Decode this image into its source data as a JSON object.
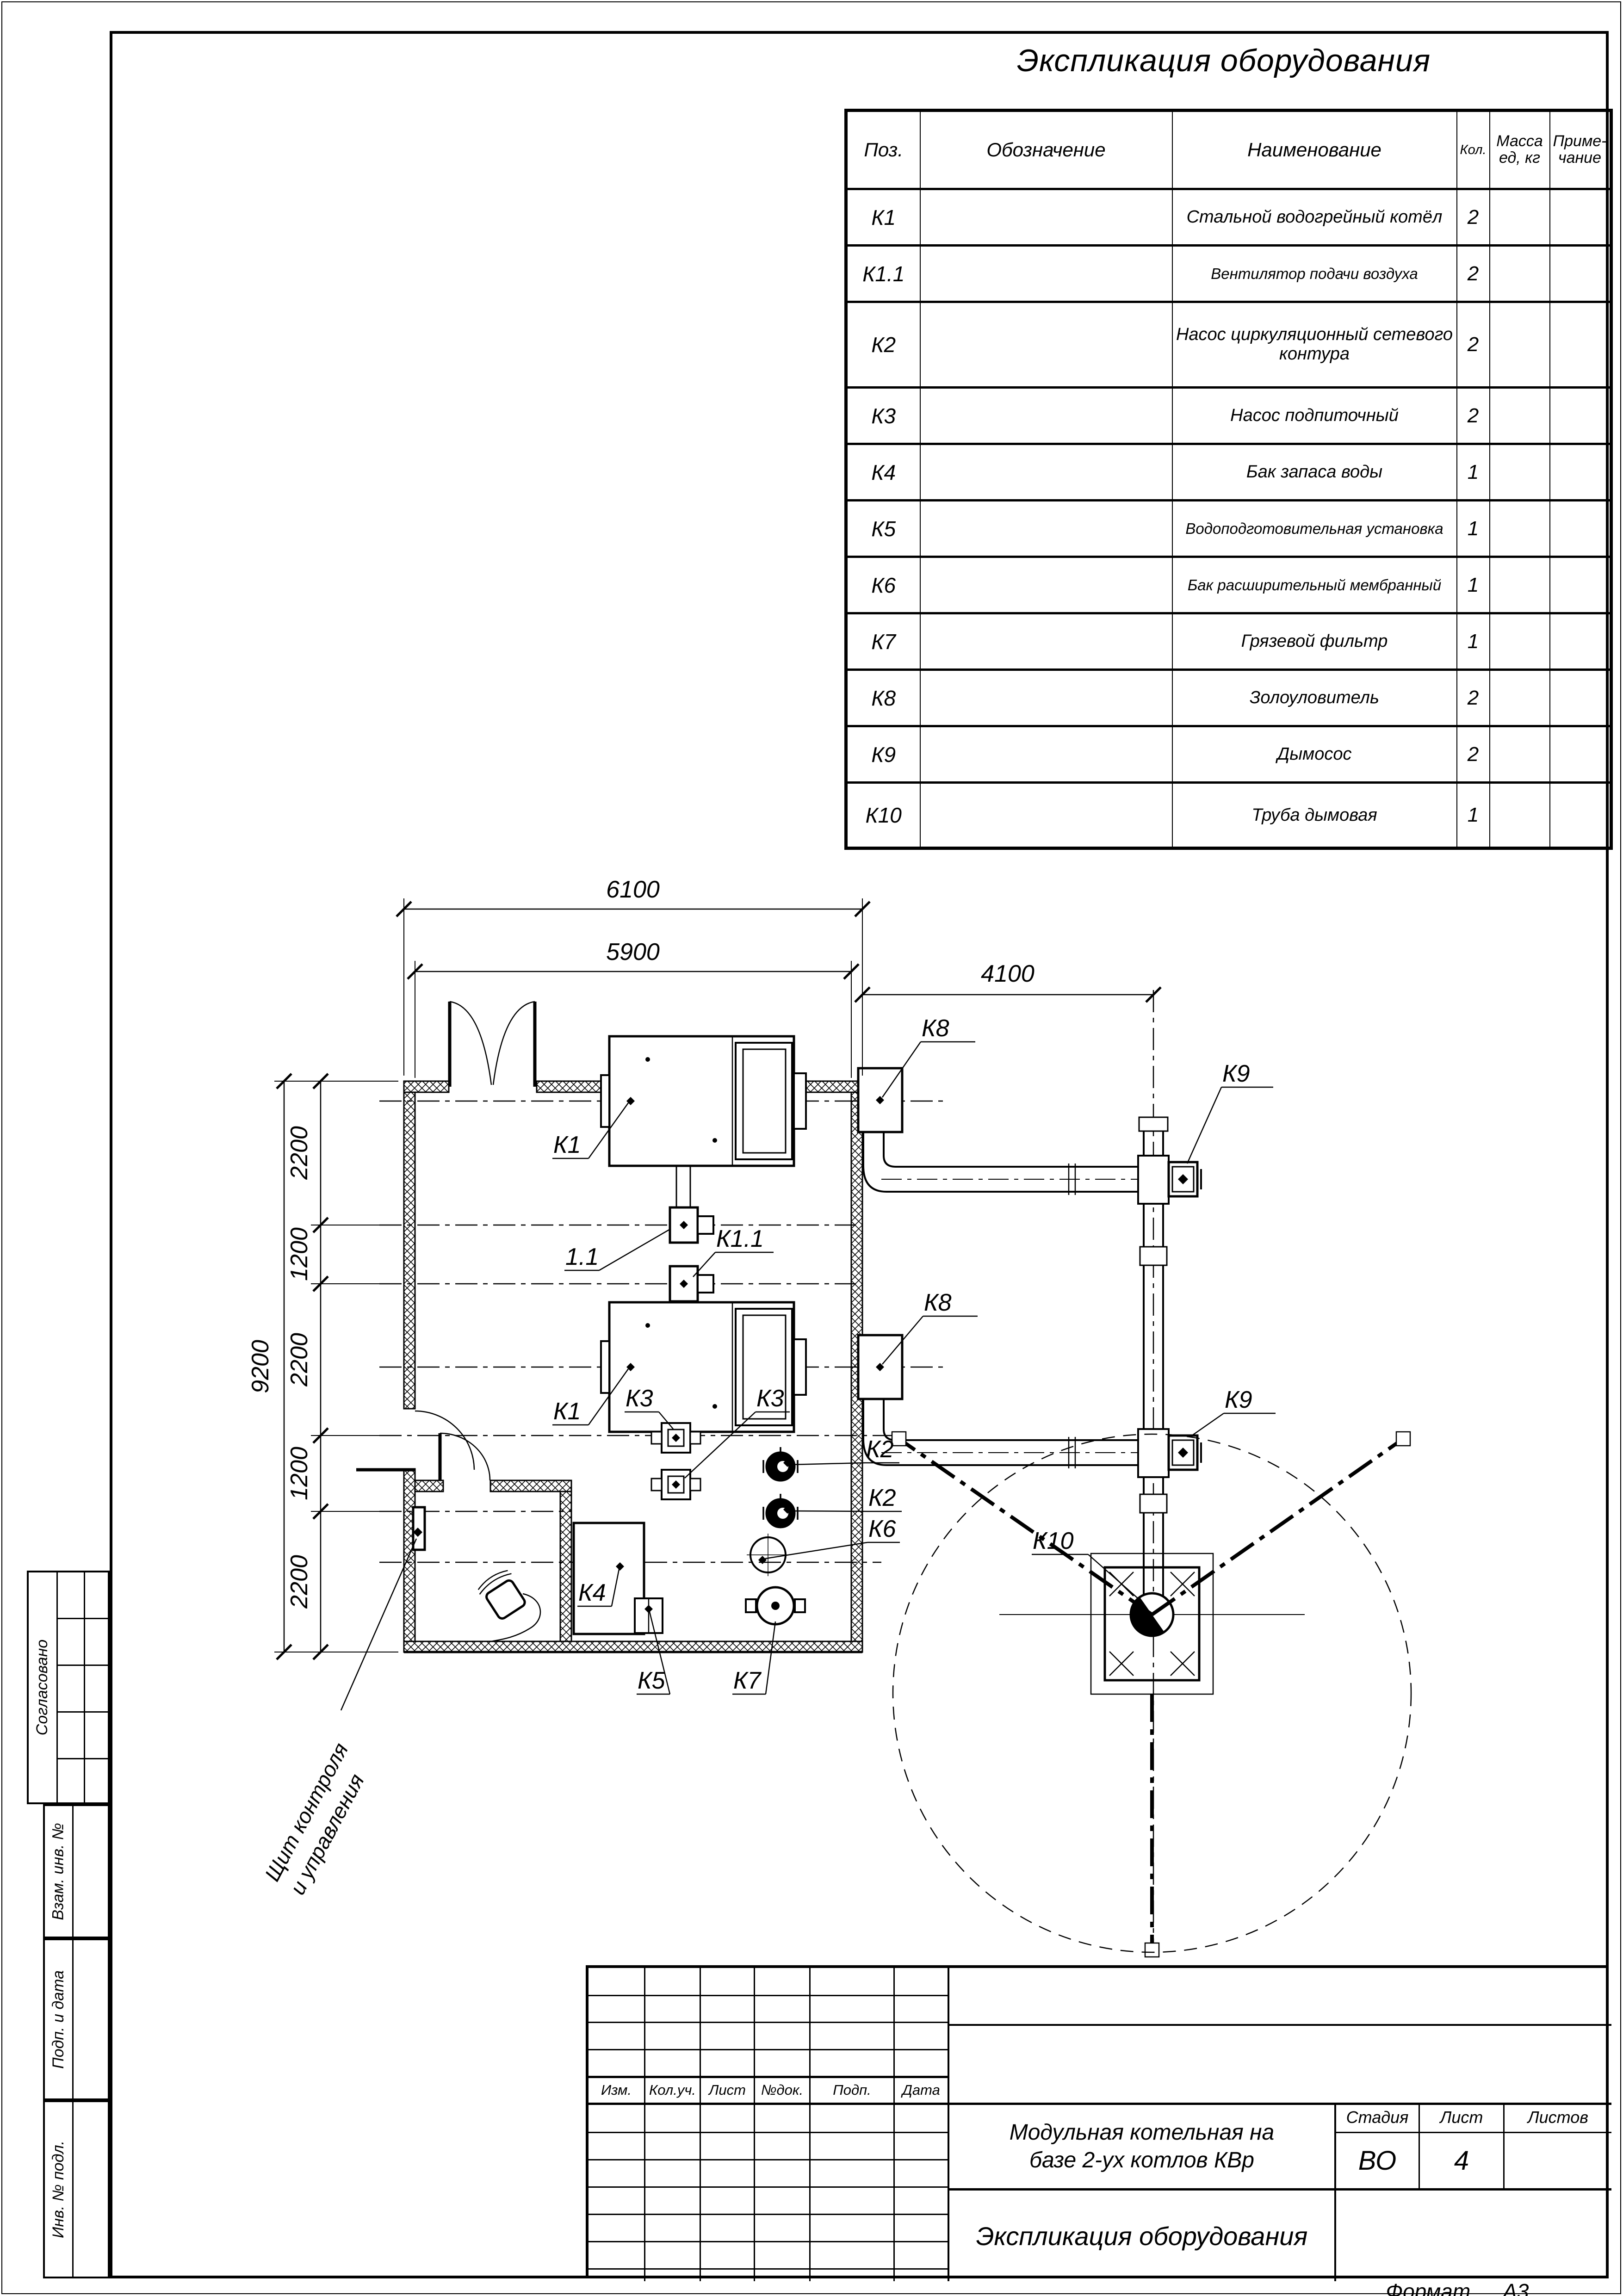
{
  "table": {
    "title": "Экспликация оборудования",
    "headers": {
      "pos": "Поз.",
      "designation": "Обозначение",
      "name": "Наименование",
      "qty": "Кол.",
      "mass_l1": "Масса",
      "mass_l2": "ед, кг",
      "note_l1": "Приме-",
      "note_l2": "чание"
    },
    "rows": [
      {
        "pos": "К1",
        "name": "Стальной водогрейный котёл",
        "qty": "2"
      },
      {
        "pos": "К1.1",
        "name": "Вентилятор подачи воздуха",
        "qty": "2"
      },
      {
        "pos": "К2",
        "name": "Насос циркуляционный сетевого контура",
        "qty": "2"
      },
      {
        "pos": "К3",
        "name": "Насос подпиточный",
        "qty": "2"
      },
      {
        "pos": "К4",
        "name": "Бак запаса воды",
        "qty": "1"
      },
      {
        "pos": "К5",
        "name": "Водоподготовительная установка",
        "qty": "1"
      },
      {
        "pos": "К6",
        "name": "Бак расширительный мембранный",
        "qty": "1"
      },
      {
        "pos": "К7",
        "name": "Грязевой фильтр",
        "qty": "1"
      },
      {
        "pos": "К8",
        "name": "Золоуловитель",
        "qty": "2"
      },
      {
        "pos": "К9",
        "name": "Дымосос",
        "qty": "2"
      },
      {
        "pos": "К10",
        "name": "Труба дымовая",
        "qty": "1"
      }
    ]
  },
  "plan": {
    "dims": {
      "w_outer": "6100",
      "w_inner": "5900",
      "h_total": "9200",
      "right": "4100",
      "segs": [
        "2200",
        "1200",
        "2200",
        "1200",
        "2200"
      ]
    },
    "labels": {
      "k1a": "К1",
      "f11": "1.1",
      "k11": "К1.1",
      "k1b": "К1",
      "k8a": "К8",
      "k9a": "К9",
      "k8b": "К8",
      "k9b": "К9",
      "k10": "К10",
      "k3a": "К3",
      "k3b": "К3",
      "k2a": "К2",
      "k2b": "К2",
      "k4": "К4",
      "k5": "К5",
      "k6": "К6",
      "k7": "К7"
    },
    "note_l1": "Щит контроля",
    "note_l2": "и управления"
  },
  "stamp": {
    "rev_headers": [
      "Изм.",
      "Кол.уч.",
      "Лист",
      "№док.",
      "Подп.",
      "Дата"
    ],
    "title_l1": "Модульная котельная на",
    "title_l2": "базе 2-ух котлов КВр",
    "stage_label": "Стадия",
    "sheet_label": "Лист",
    "sheets_label": "Листов",
    "stage": "ВО",
    "sheet_no": "4",
    "subtitle": "Экспликация оборудования",
    "format_label": "Формат",
    "format": "А3"
  },
  "margin": {
    "approved": "Согласовано",
    "replace": "Взам. инв. №",
    "sign": "Подп. и дата",
    "inv": "Инв. № подл."
  }
}
